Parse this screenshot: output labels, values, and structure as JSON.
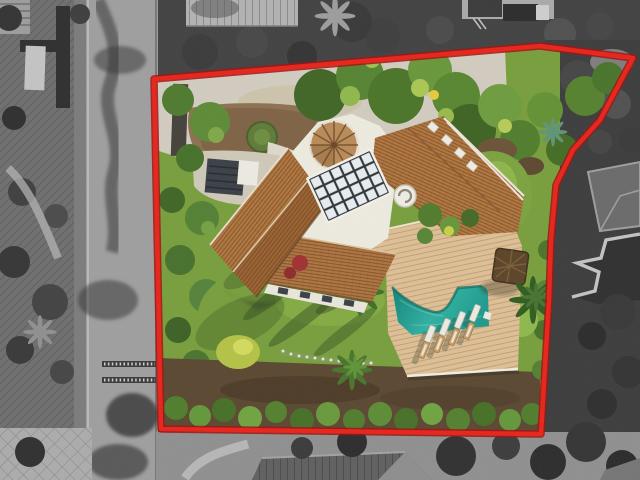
{
  "image": {
    "kind": "aerial-drone-photograph",
    "subject": "Villa plot highlighted with a red boundary outline; area inside the boundary is in colour, surroundings are desaturated grayscale",
    "width_px": 640,
    "height_px": 480,
    "visible_text": "none"
  },
  "boundary": {
    "points": "154,79 330,64 540,46 633,58 600,120 573,150 556,185 551,240 549,300 541,434 161,429",
    "stroke_color": "#e8231a",
    "outline_color": "#9e120e",
    "stroke_width": 4.5
  },
  "palette": {
    "road": "#9e9e9e",
    "driveway": "#d2ccbf",
    "lawn": "#779e3c",
    "deck": "#ddbf95",
    "pool_deep": "#0f8276",
    "pool_light": "#2fb0a1",
    "roof_tile": "#b0763e",
    "roof_white": "#edebdf",
    "hedge": "#5a8a2e",
    "soil": "#5a4731"
  },
  "scene": {
    "inside_boundary": [
      "concrete driveway",
      "dirt mound with circular shrub",
      "villa with terracotta tiled wings",
      "conical tower roof",
      "glass skylight grid",
      "spiral chimney",
      "green lawn",
      "palm trees",
      "wooden pool deck",
      "freeform turquoise swimming pool",
      "eight sun loungers",
      "thatched parasol",
      "white flower bed",
      "boundary hedge"
    ],
    "outside_boundary": [
      "street with tree shadows",
      "neighbour driveways",
      "neighbour pitched roofs",
      "flatbed truck",
      "dense trees",
      "stepped terrace structure"
    ]
  }
}
